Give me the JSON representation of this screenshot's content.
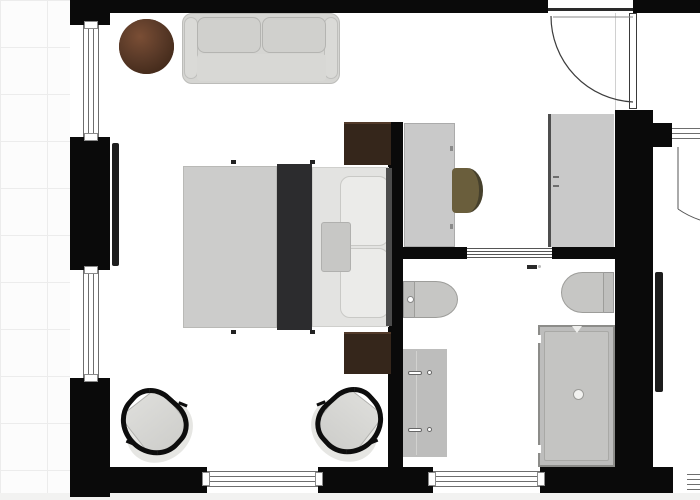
{
  "canvas": {
    "type": "floor-plan",
    "grid_visible": true,
    "text_labels": []
  },
  "rooms": [
    "bedroom",
    "entry-dressing-area",
    "bathroom"
  ],
  "colors": {
    "wall": "#0a0a0a",
    "floor": "#ffffff",
    "grid_line": "#ececec",
    "furniture_gray": "#c9c9c9",
    "sofa_gray": "#d5d5d2",
    "bed_duvet": "#cccccb",
    "bed_runner": "#2c2c2e",
    "bed_sheet": "#e3e3e1",
    "pillow": "#ebebe9",
    "nightstand_wood": "#35261b",
    "table_wood": "#5a3a28",
    "desk_chair_olive": "#6a5e3c",
    "fixture_gray": "#bfbfbd",
    "shower_gray": "#bdbdbc",
    "tv_black": "#1d1d1d",
    "window_line": "#6e6e6e"
  },
  "items": [
    {
      "name": "entry-door",
      "room": "entry-dressing-area",
      "kind": "hinged-door-with-swing-arc"
    },
    {
      "name": "sliding-bathroom-door",
      "room": "bathroom",
      "kind": "sliding-door"
    },
    {
      "name": "window-left-upper",
      "room": "bedroom",
      "kind": "window"
    },
    {
      "name": "window-left-lower",
      "room": "bedroom",
      "kind": "window"
    },
    {
      "name": "window-bottom-bedroom",
      "room": "bedroom",
      "kind": "window"
    },
    {
      "name": "window-bottom-bathroom",
      "room": "bathroom",
      "kind": "window"
    },
    {
      "name": "sofa",
      "room": "bedroom",
      "kind": "two-seat-sofa"
    },
    {
      "name": "round-side-table",
      "room": "bedroom",
      "kind": "wood-table"
    },
    {
      "name": "wall-tv",
      "room": "bedroom",
      "kind": "tv"
    },
    {
      "name": "double-bed",
      "room": "bedroom",
      "kind": "bed-with-pillows-and-runner"
    },
    {
      "name": "nightstand-top",
      "room": "bedroom",
      "kind": "nightstand"
    },
    {
      "name": "nightstand-bottom",
      "room": "bedroom",
      "kind": "nightstand"
    },
    {
      "name": "armchair-left",
      "room": "bedroom",
      "kind": "armchair"
    },
    {
      "name": "armchair-right",
      "room": "bedroom",
      "kind": "armchair"
    },
    {
      "name": "desk",
      "room": "entry-dressing-area",
      "kind": "desk"
    },
    {
      "name": "desk-chair",
      "room": "entry-dressing-area",
      "kind": "chair"
    },
    {
      "name": "wardrobe",
      "room": "entry-dressing-area",
      "kind": "closet"
    },
    {
      "name": "toilet",
      "room": "bathroom",
      "kind": "toilet"
    },
    {
      "name": "bidet",
      "room": "bathroom",
      "kind": "bidet"
    },
    {
      "name": "double-vanity",
      "room": "bathroom",
      "kind": "vanity-two-sinks"
    },
    {
      "name": "shower",
      "room": "bathroom",
      "kind": "walk-in-shower"
    },
    {
      "name": "adjacent-room-door",
      "room": "exterior",
      "kind": "door-partial"
    },
    {
      "name": "adjacent-room-tv",
      "room": "exterior",
      "kind": "tv"
    }
  ]
}
